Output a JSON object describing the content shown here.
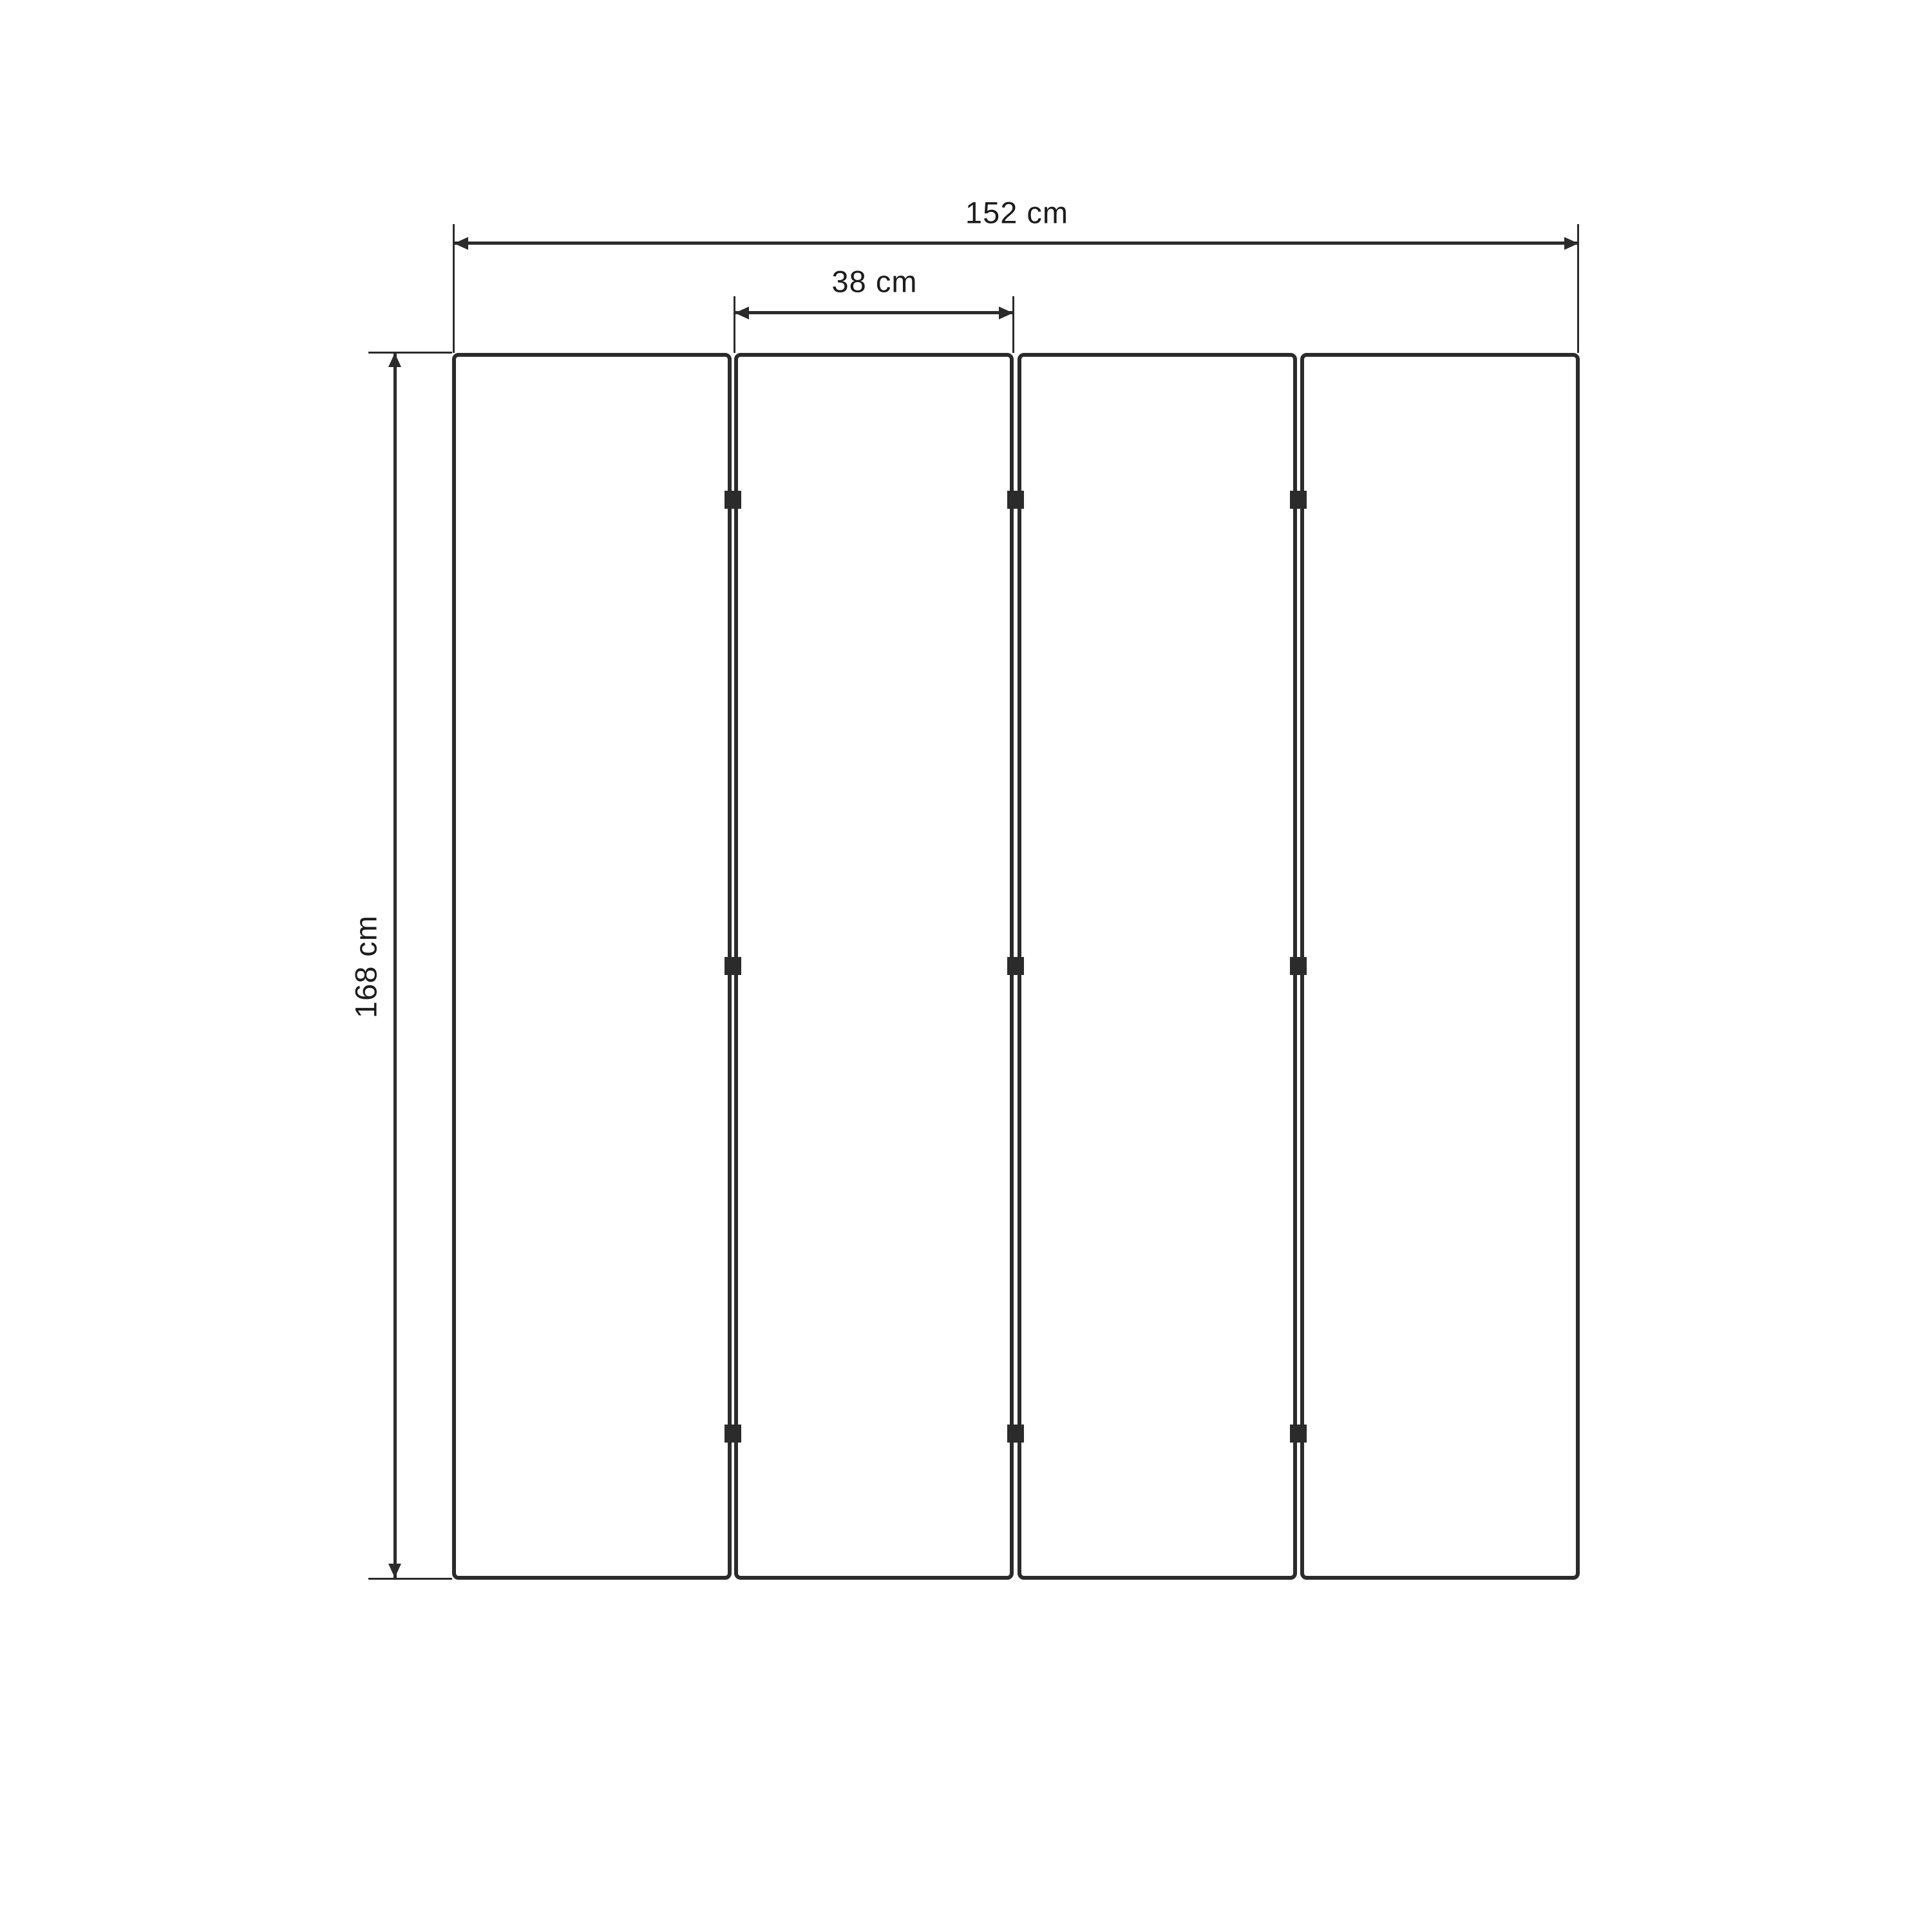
{
  "diagram": {
    "panel_count": 4,
    "labels": {
      "total_width": "152 cm",
      "panel_width": "38 cm",
      "height": "168 cm"
    },
    "colors": {
      "line": "#2b2b2b",
      "text": "#1c1c1c",
      "background": "#ffffff"
    }
  }
}
